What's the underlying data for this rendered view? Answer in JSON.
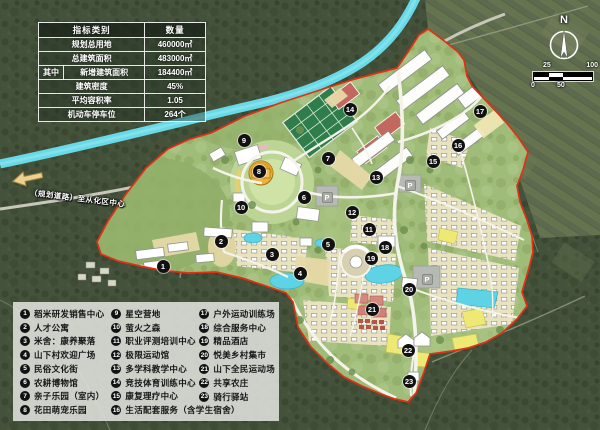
{
  "stats_table": {
    "header": {
      "category": "指标类别",
      "quantity": "数量"
    },
    "rows": [
      {
        "prefix": "",
        "label": "规划总用地",
        "value": "460000㎡"
      },
      {
        "prefix": "",
        "label": "总建筑面积",
        "value": "483000㎡"
      },
      {
        "prefix": "其中",
        "label": "新增建筑面积",
        "value": "184400㎡"
      },
      {
        "prefix": "",
        "label": "建筑密度",
        "value": "45%"
      },
      {
        "prefix": "",
        "label": "平均容积率",
        "value": "1.05"
      },
      {
        "prefix": "",
        "label": "机动车停车位",
        "value": "264个"
      }
    ]
  },
  "compass": {
    "north_label": "N"
  },
  "scale_bar": {
    "labels_top": [
      "25",
      "100"
    ],
    "labels_bottom": [
      "0",
      "50"
    ]
  },
  "road_annotation": {
    "label": "（规划道路）至从化区中心"
  },
  "legend": {
    "columns": [
      [
        {
          "num": "1",
          "label": "稻米研发销售中心"
        },
        {
          "num": "2",
          "label": "人才公寓"
        },
        {
          "num": "3",
          "label": "米舍：康养聚落"
        },
        {
          "num": "4",
          "label": "山下村欢迎广场"
        },
        {
          "num": "5",
          "label": "民俗文化街"
        },
        {
          "num": "6",
          "label": "农耕博物馆"
        },
        {
          "num": "7",
          "label": "亲子乐园（室内）"
        },
        {
          "num": "8",
          "label": "花田萌宠乐园"
        }
      ],
      [
        {
          "num": "9",
          "label": "星空营地"
        },
        {
          "num": "10",
          "label": "萤火之森"
        },
        {
          "num": "11",
          "label": "职业评测培训中心"
        },
        {
          "num": "12",
          "label": "极限运动馆"
        },
        {
          "num": "13",
          "label": "多学科教学中心"
        },
        {
          "num": "14",
          "label": "竞技体育训练中心"
        },
        {
          "num": "15",
          "label": "康复理疗中心"
        },
        {
          "num": "16",
          "label": "生活配套服务（含学生宿舍）"
        }
      ],
      [
        {
          "num": "17",
          "label": "户外运动训练场"
        },
        {
          "num": "18",
          "label": "综合服务中心"
        },
        {
          "num": "19",
          "label": "精品酒店"
        },
        {
          "num": "20",
          "label": "悦美乡村集市"
        },
        {
          "num": "21",
          "label": "山下全民运动场"
        },
        {
          "num": "22",
          "label": "共享农庄"
        },
        {
          "num": "23",
          "label": "骑行驿站"
        }
      ]
    ]
  },
  "map": {
    "parking_label": "P",
    "markers": [
      {
        "num": "1",
        "x": 163,
        "y": 266
      },
      {
        "num": "2",
        "x": 221,
        "y": 241
      },
      {
        "num": "3",
        "x": 272,
        "y": 254
      },
      {
        "num": "4",
        "x": 300,
        "y": 273
      },
      {
        "num": "5",
        "x": 328,
        "y": 244
      },
      {
        "num": "6",
        "x": 304,
        "y": 197
      },
      {
        "num": "7",
        "x": 328,
        "y": 158
      },
      {
        "num": "8",
        "x": 259,
        "y": 171
      },
      {
        "num": "9",
        "x": 244,
        "y": 140
      },
      {
        "num": "10",
        "x": 241,
        "y": 207
      },
      {
        "num": "11",
        "x": 369,
        "y": 229
      },
      {
        "num": "12",
        "x": 352,
        "y": 212
      },
      {
        "num": "13",
        "x": 376,
        "y": 177
      },
      {
        "num": "14",
        "x": 350,
        "y": 109
      },
      {
        "num": "15",
        "x": 433,
        "y": 161
      },
      {
        "num": "16",
        "x": 458,
        "y": 145
      },
      {
        "num": "17",
        "x": 480,
        "y": 111
      },
      {
        "num": "18",
        "x": 385,
        "y": 247
      },
      {
        "num": "19",
        "x": 371,
        "y": 258
      },
      {
        "num": "20",
        "x": 409,
        "y": 289
      },
      {
        "num": "21",
        "x": 372,
        "y": 309
      },
      {
        "num": "22",
        "x": 408,
        "y": 350
      },
      {
        "num": "23",
        "x": 409,
        "y": 381
      }
    ],
    "parking": [
      {
        "x": 327,
        "y": 197
      },
      {
        "x": 410,
        "y": 185
      },
      {
        "x": 427,
        "y": 279
      }
    ]
  },
  "colors": {
    "boundary": "#e23016",
    "river": "#69d9e7",
    "plan_green": "#a0bc79",
    "pond": "#5fd3e6",
    "field_yellow": "#eee975",
    "marker_bg": "#111111",
    "legend_bg": "#e4e6e2"
  }
}
